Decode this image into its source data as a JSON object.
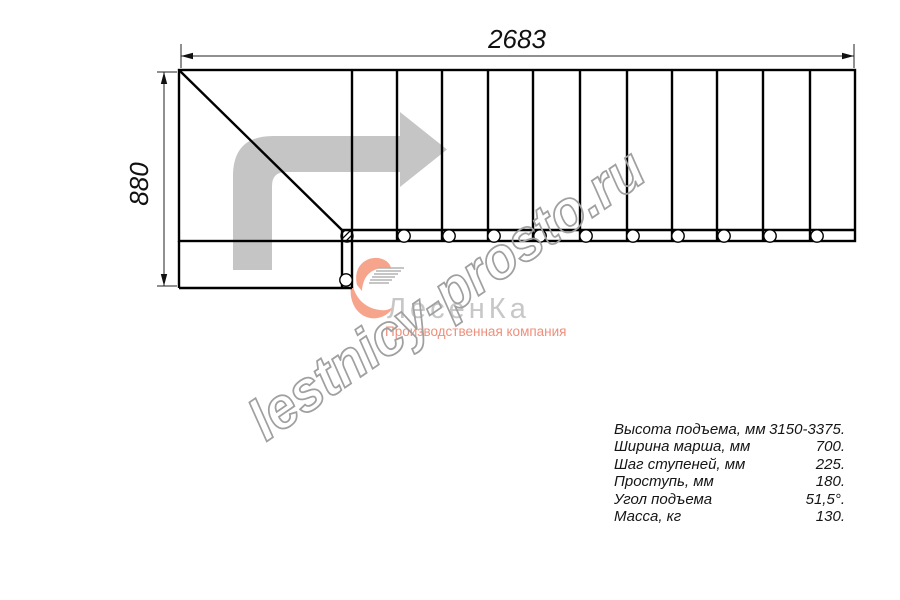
{
  "drawing": {
    "type": "staircase-plan-top-view",
    "treads_count": 11,
    "balusters_count": 12,
    "width_dimension_label": "2683",
    "height_dimension_label": "880",
    "colors": {
      "line": "#000000",
      "dimension_line": "#222222",
      "direction_arrow": "#c5c5c5",
      "watermark": "#a0a0a0",
      "logo_name": "#c7c7c7",
      "logo_accent": "#ee8f7b",
      "logo_icon": "#f6a58c"
    }
  },
  "watermark": {
    "text": "lestnicy-prosto.ru"
  },
  "logo": {
    "name": "ЛесенКа",
    "tagline": "Производственная компания"
  },
  "specs": {
    "rows": [
      {
        "label": "Высота подъема, мм",
        "value": "3150-3375."
      },
      {
        "label": "Ширина марша, мм",
        "value": "700."
      },
      {
        "label": "Шаг ступеней, мм",
        "value": "225."
      },
      {
        "label": "Проступь, мм",
        "value": "180."
      },
      {
        "label": "Угол подъема",
        "value": "51,5°."
      },
      {
        "label": "Масса, кг",
        "value": "130."
      }
    ]
  }
}
